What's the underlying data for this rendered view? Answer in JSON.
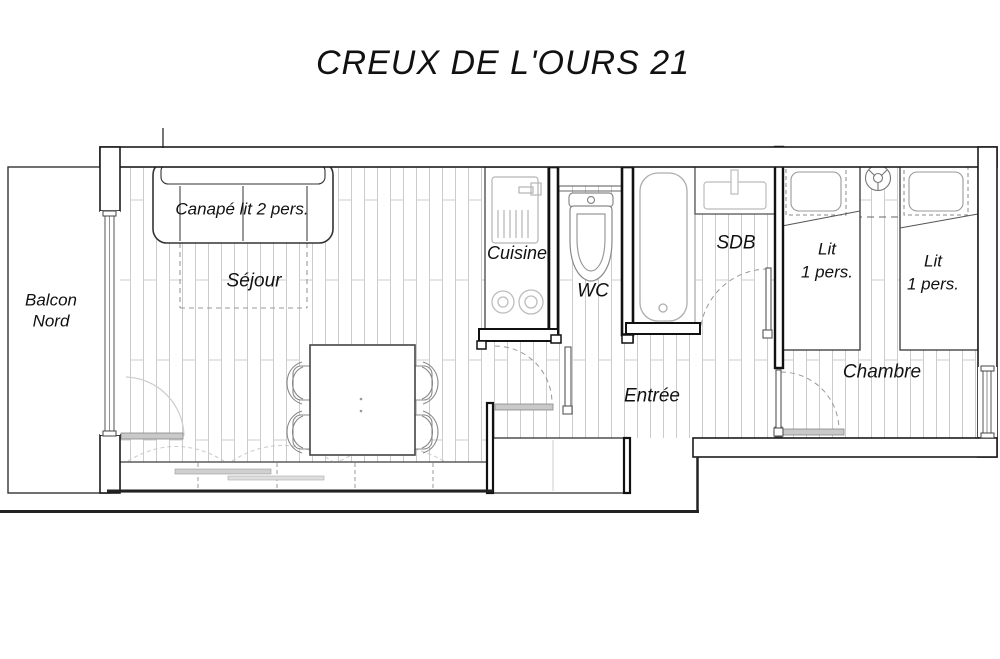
{
  "title": "CREUX DE L'OURS 21",
  "rooms": {
    "balcony_line1": "Balcon",
    "balcony_line2": "Nord",
    "living": "Séjour",
    "kitchen": "Cuisine",
    "wc": "WC",
    "bathroom": "SDB",
    "hall": "Entrée",
    "bedroom": "Chambre"
  },
  "furniture": {
    "sofa_label": "Canapé lit 2 pers.",
    "bed_left_line1": "Lit",
    "bed_left_line2": "1 pers.",
    "bed_right_line1": "Lit",
    "bed_right_line2": "1 pers."
  },
  "colors": {
    "wall_line": "#1a1a1a",
    "interior_wall_line": "#111111",
    "fixture_line": "#9a9a9a",
    "parquet_line": "#cccccc",
    "door_leaf_fill": "#c9c9c9",
    "dashed_line": "#999999",
    "text": "#111111",
    "background": "#ffffff"
  }
}
